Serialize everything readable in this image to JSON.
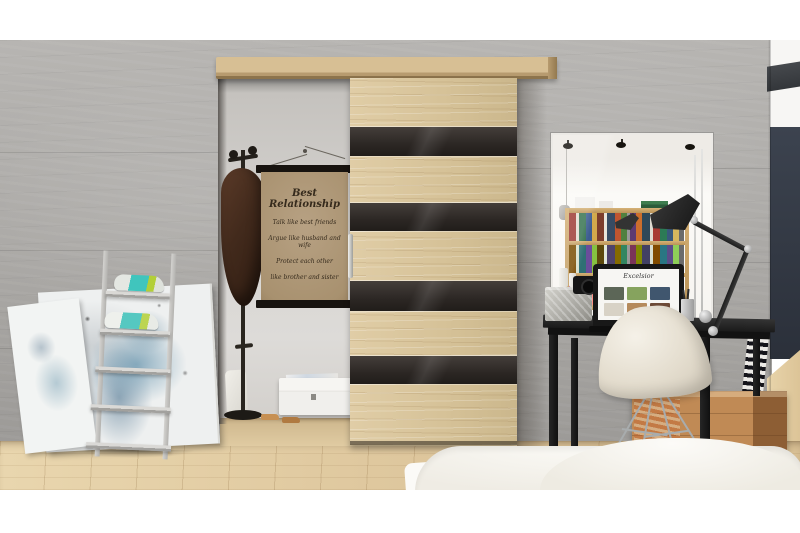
{
  "meta": {
    "type": "interior-photograph",
    "description": "Bedroom interior with a wooden sliding door striped with dark glass panels, a ladder shoe shelf with sneakers and leaning canvases on the left, and a black vanity desk with mirror, lamp, laptop and white shell chair on the right"
  },
  "poster": {
    "title": "Best Relationship",
    "lines": [
      "Talk like best friends",
      "Argue like husband and wife",
      "Protect each other",
      "like brother and sister"
    ]
  },
  "laptop": {
    "screen_title": "Excelsior"
  },
  "palette": {
    "wall_concrete": "#aaa8a5",
    "door_wood": "#d6c298",
    "door_glass": "#2c2724",
    "floor_wood": "#dcc49a",
    "navy_panel": "#343b46",
    "crate_wood": "#b5814f",
    "desk_black": "#1a1a1a",
    "chair_shell": "#e3dccd",
    "sneaker_teal": "#55c8c1",
    "sneaker_lime": "#bcd551"
  },
  "objects": [
    {
      "label": "sliding-door"
    },
    {
      "label": "door-rail"
    },
    {
      "label": "wall-poster"
    },
    {
      "label": "coat-stand"
    },
    {
      "label": "ladder-shoe-shelf"
    },
    {
      "label": "leaning-canvases"
    },
    {
      "label": "vanity-mirror"
    },
    {
      "label": "bookshelf-reflection"
    },
    {
      "label": "desk-lamp"
    },
    {
      "label": "black-desk"
    },
    {
      "label": "laptop"
    },
    {
      "label": "camera"
    },
    {
      "label": "shell-chair"
    },
    {
      "label": "wooden-crate"
    },
    {
      "label": "bed-duvet"
    }
  ]
}
